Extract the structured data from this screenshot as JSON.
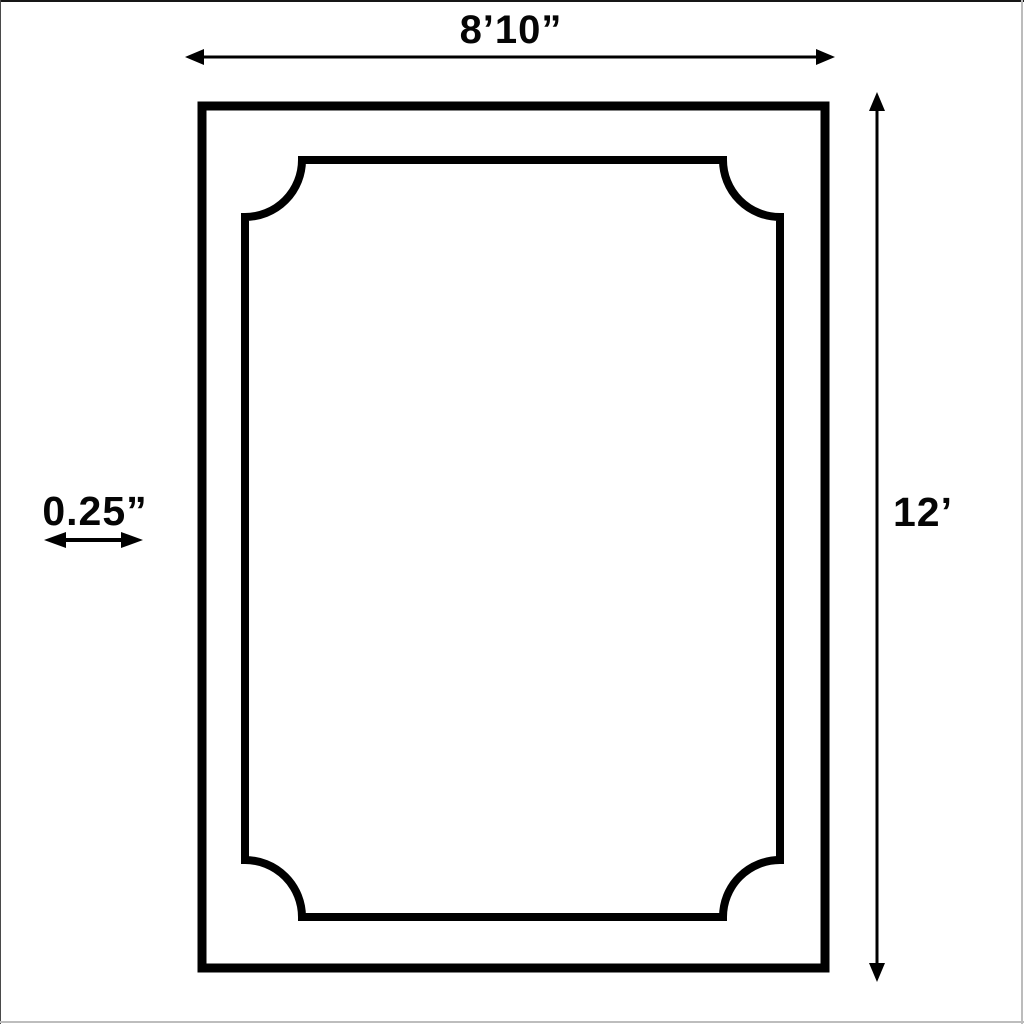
{
  "colors": {
    "ink": "#000000",
    "background": "#ffffff"
  },
  "diagram": {
    "type": "dimension-drawing",
    "shape": "rectangle-with-scalloped-inner-border",
    "width_label": "8’10”",
    "height_label": "12’",
    "thickness_label": "0.25”"
  }
}
